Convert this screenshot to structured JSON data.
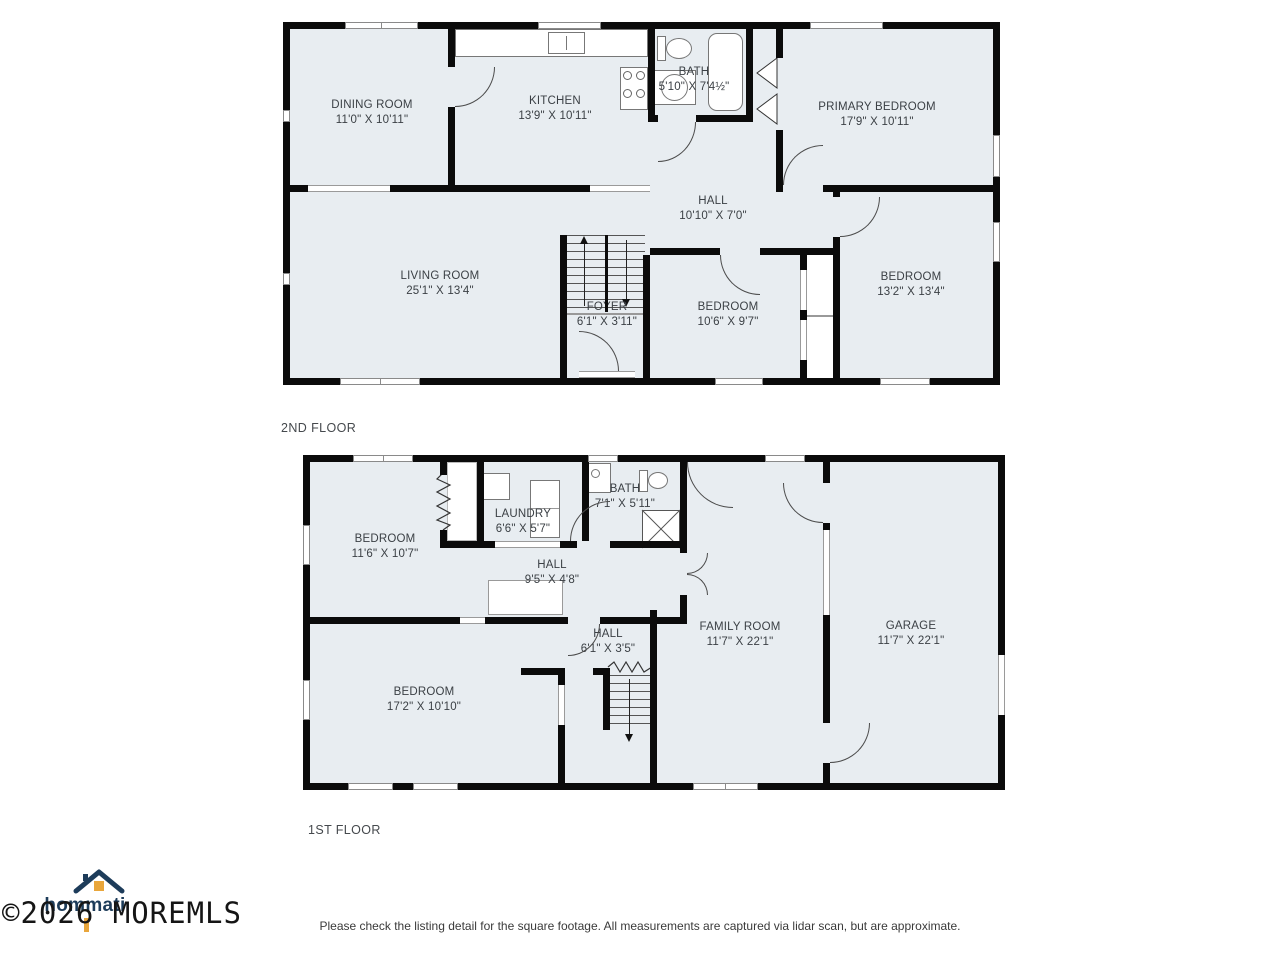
{
  "floors": [
    {
      "label": "2ND FLOOR",
      "rooms": [
        {
          "name": "DINING ROOM",
          "dims": "11'0\" X 10'11\""
        },
        {
          "name": "KITCHEN",
          "dims": "13'9\" X 10'11\""
        },
        {
          "name": "BATH",
          "dims": "5'10\" X 7'4½\""
        },
        {
          "name": "PRIMARY BEDROOM",
          "dims": "17'9\" X 10'11\""
        },
        {
          "name": "HALL",
          "dims": "10'10\" X 7'0\""
        },
        {
          "name": "LIVING ROOM",
          "dims": "25'1\" X 13'4\""
        },
        {
          "name": "FOYER",
          "dims": "6'1\" X 3'11\""
        },
        {
          "name": "BEDROOM",
          "dims": "10'6\" X 9'7\""
        },
        {
          "name": "BEDROOM",
          "dims": "13'2\" X 13'4\""
        }
      ]
    },
    {
      "label": "1ST FLOOR",
      "rooms": [
        {
          "name": "BEDROOM",
          "dims": "11'6\" X 10'7\""
        },
        {
          "name": "LAUNDRY",
          "dims": "6'6\" X 5'7\""
        },
        {
          "name": "BATH",
          "dims": "7'1\" X 5'11\""
        },
        {
          "name": "HALL",
          "dims": "9'5\" X 4'8\""
        },
        {
          "name": "HALL",
          "dims": "6'1\" X 3'5\""
        },
        {
          "name": "BEDROOM",
          "dims": "17'2\" X 10'10\""
        },
        {
          "name": "FAMILY ROOM",
          "dims": "11'7\" X 22'1\""
        },
        {
          "name": "GARAGE",
          "dims": "11'7\" X 22'1\""
        }
      ]
    }
  ],
  "logo": {
    "text": "hommati",
    "icon": "house-icon"
  },
  "footer": {
    "copyright": "©2026 MOREMLS",
    "disclaimer": "Please check the listing detail for the square footage. All measurements are captured via lidar scan, but are approximate."
  },
  "colors": {
    "room_fill": "#e8edf1",
    "wall": "#0b0b0b",
    "logo_navy": "#1d3c5a",
    "logo_orange": "#e9a63b"
  }
}
